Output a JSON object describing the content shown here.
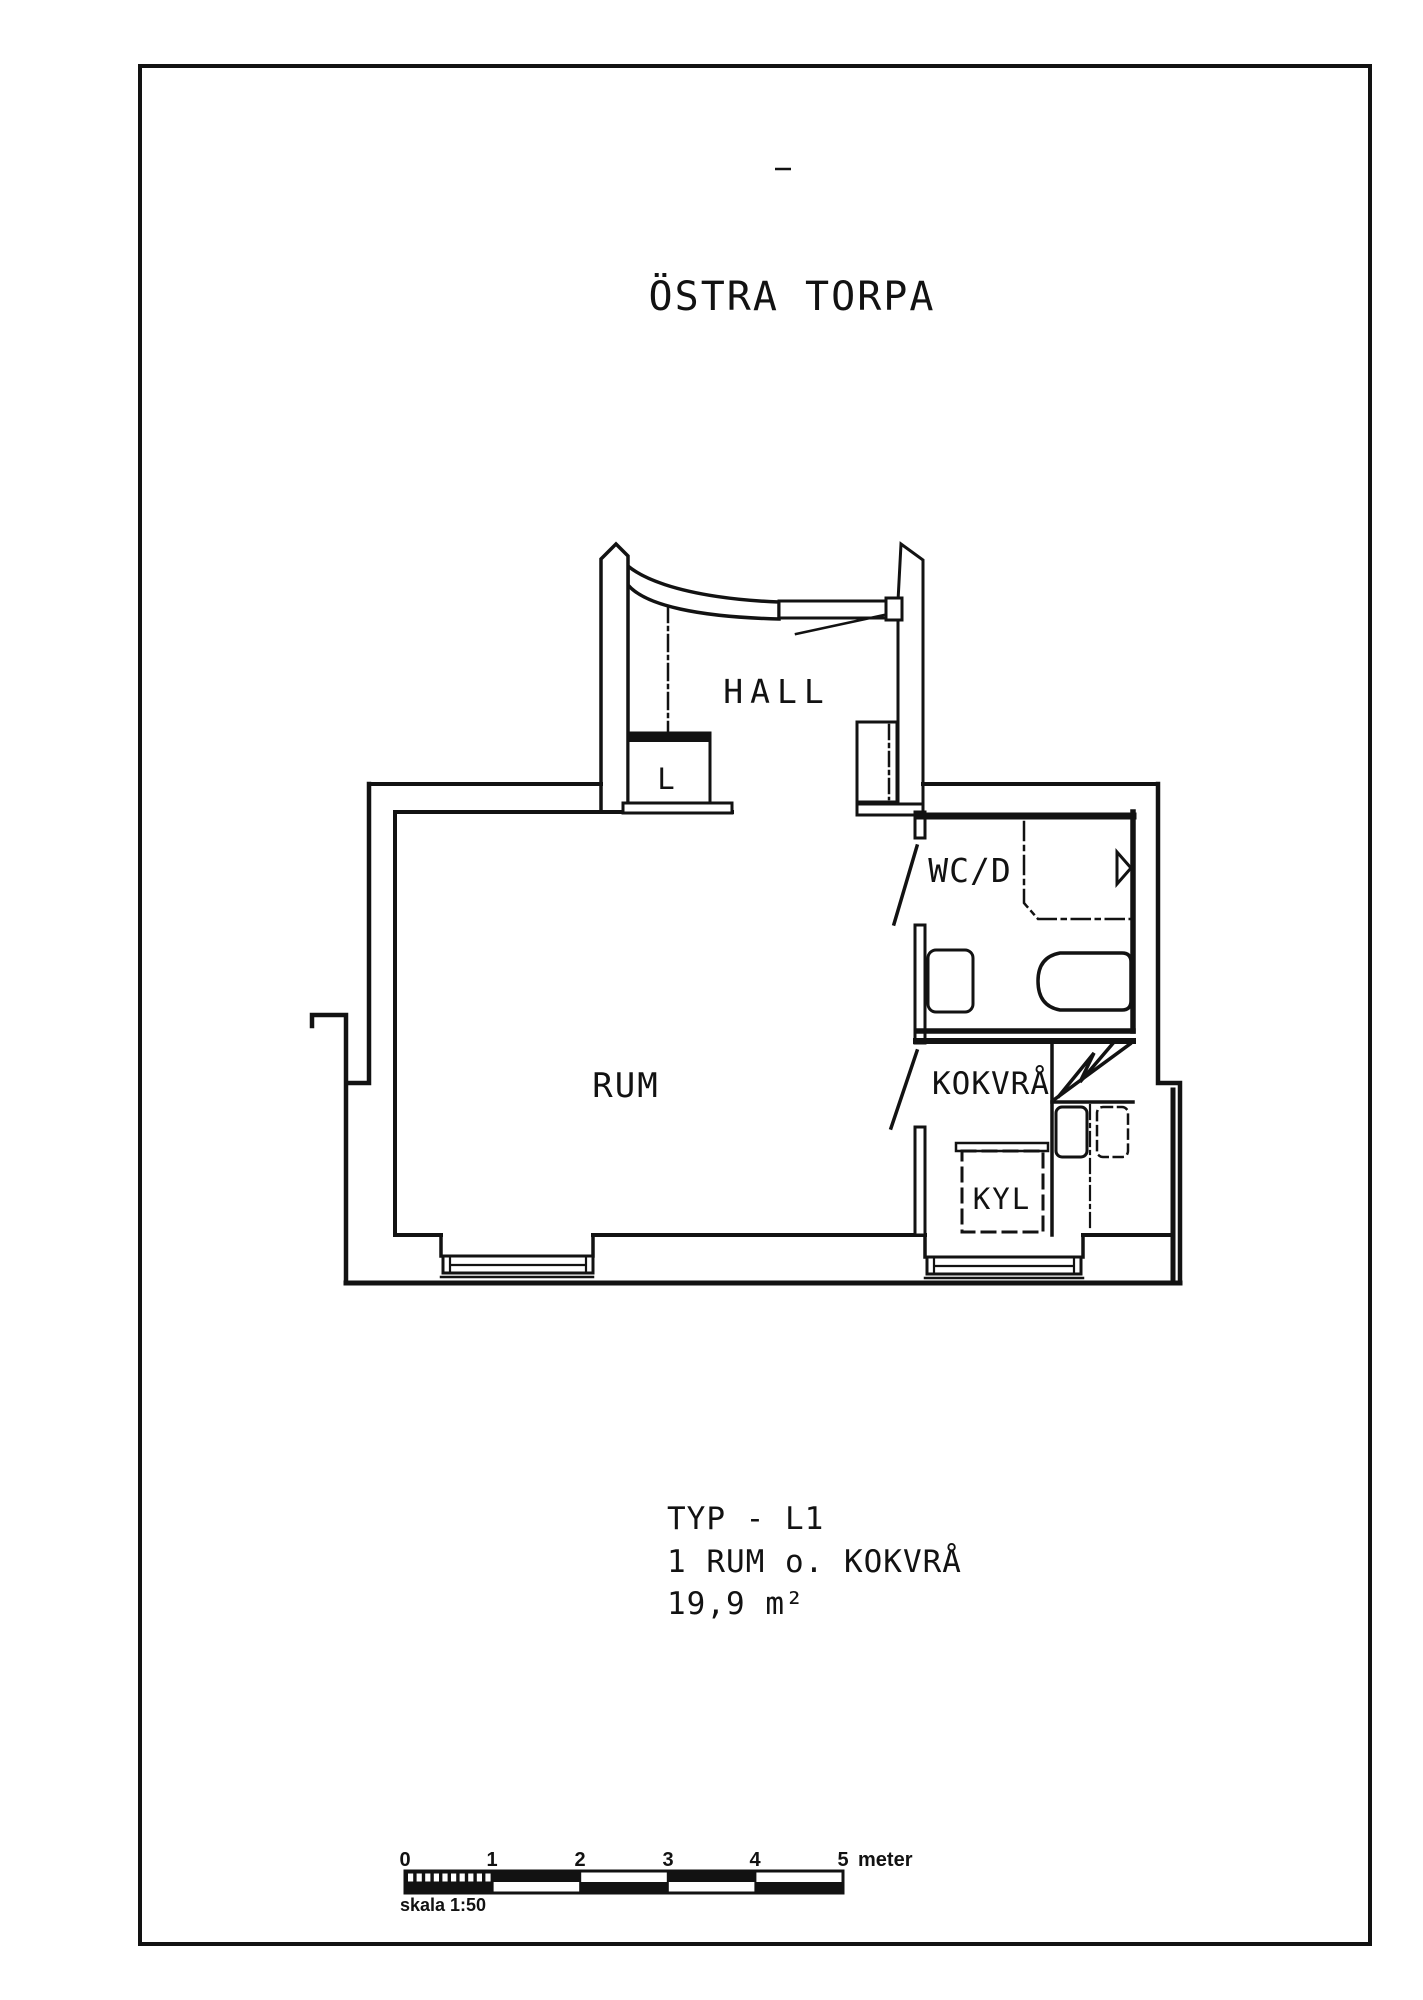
{
  "page": {
    "background": "#ffffff",
    "ink": "#121212"
  },
  "title": "ÖSTRA TORPA",
  "plan": {
    "hall_label": "HALL",
    "closet_label": "L",
    "wc_label": "WC/D",
    "room_label": "RUM",
    "kitchenette_label": "KOKVRÅ",
    "fridge_label": "KYL"
  },
  "caption": {
    "type_line": "TYP - L1",
    "rooms_line": "1 RUM o. KOKVRÅ",
    "area_line": "19,9 m²"
  },
  "scalebar": {
    "ticks": [
      "0",
      "1",
      "2",
      "3",
      "4",
      "5"
    ],
    "unit_label": "meter",
    "caption": "skala 1:50"
  }
}
